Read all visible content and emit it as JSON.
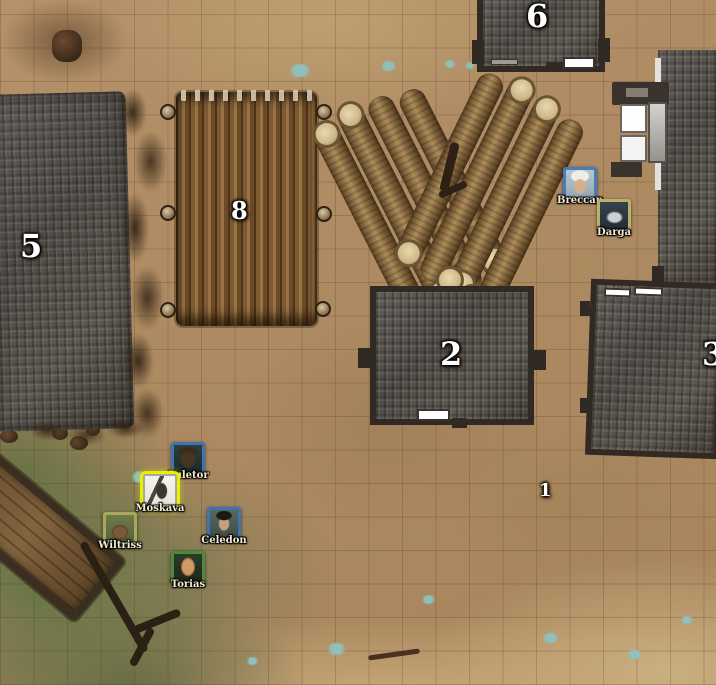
{
  "map": {
    "grid_size_px": 33,
    "markers": [
      {
        "id": "marker-1",
        "label": "1"
      },
      {
        "id": "marker-2",
        "label": "2"
      },
      {
        "id": "marker-3",
        "label": "3"
      },
      {
        "id": "marker-5",
        "label": "5"
      },
      {
        "id": "marker-6",
        "label": "6"
      },
      {
        "id": "marker-8",
        "label": "8"
      }
    ],
    "colors": {
      "ground": "#b2906a",
      "grass": "#68774a",
      "sand": "#c8ab7c",
      "roof": "#55514c",
      "roof_frame": "#312923",
      "door_white": "#ffffff",
      "log_wood": "#8a6a42",
      "log_cut_end": "#e2d3a8",
      "palisade_pole": "#7d5a34",
      "water_patch": "#8fc0bc",
      "selection_ring": "#e8f000",
      "marker_text": "#ffffff"
    }
  },
  "tokens": [
    {
      "name": "Breccan",
      "border_color": "#4a7ab8",
      "portrait": "pale-man-white-hair",
      "selected": false
    },
    {
      "name": "Darga",
      "border_color": "#b9b06a",
      "portrait": "white-wolf",
      "selected": false
    },
    {
      "name": "Suletor",
      "border_color": "#3f74b0",
      "portrait": "dark-elk",
      "selected": false
    },
    {
      "name": "Moskava",
      "border_color": "#e8f000",
      "portrait": "ink-sketch-figure",
      "selected": true
    },
    {
      "name": "Wiltriss",
      "border_color": "#a8a858",
      "portrait": "brown-ape",
      "selected": false
    },
    {
      "name": "Celedon",
      "border_color": "#3f74b0",
      "portrait": "dark-haired-man",
      "selected": false
    },
    {
      "name": "Torias",
      "border_color": "#4a8a3a",
      "portrait": "bald-man",
      "selected": false
    }
  ]
}
